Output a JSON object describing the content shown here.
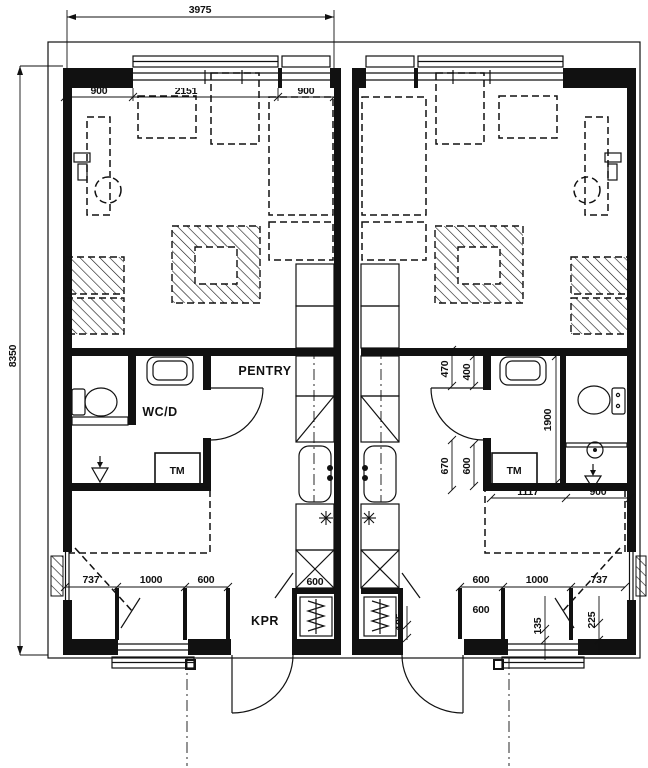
{
  "plan": {
    "overall": {
      "width_dim": "3975",
      "height_dim": "8350"
    },
    "left_unit": {
      "top_dims": [
        "900",
        "2151",
        "900"
      ],
      "bottom_dims": [
        "737",
        "1000",
        "600"
      ],
      "closet_dim": "600",
      "labels": {
        "pentry": "PENTRY",
        "wc": "WC/D",
        "tm": "TM",
        "kpr": "KPR"
      }
    },
    "right_unit": {
      "bottom_dims": [
        "600",
        "1000",
        "737"
      ],
      "closet_dim": "600",
      "labels": {
        "tm": "TM"
      },
      "bath_dims": {
        "d470": "470",
        "d400": "400",
        "d670": "670",
        "d600": "600",
        "d1900": "1900",
        "d1117": "1117",
        "d900": "900"
      },
      "small_dims": {
        "d185": "185",
        "d135": "135",
        "d225": "225"
      }
    }
  }
}
